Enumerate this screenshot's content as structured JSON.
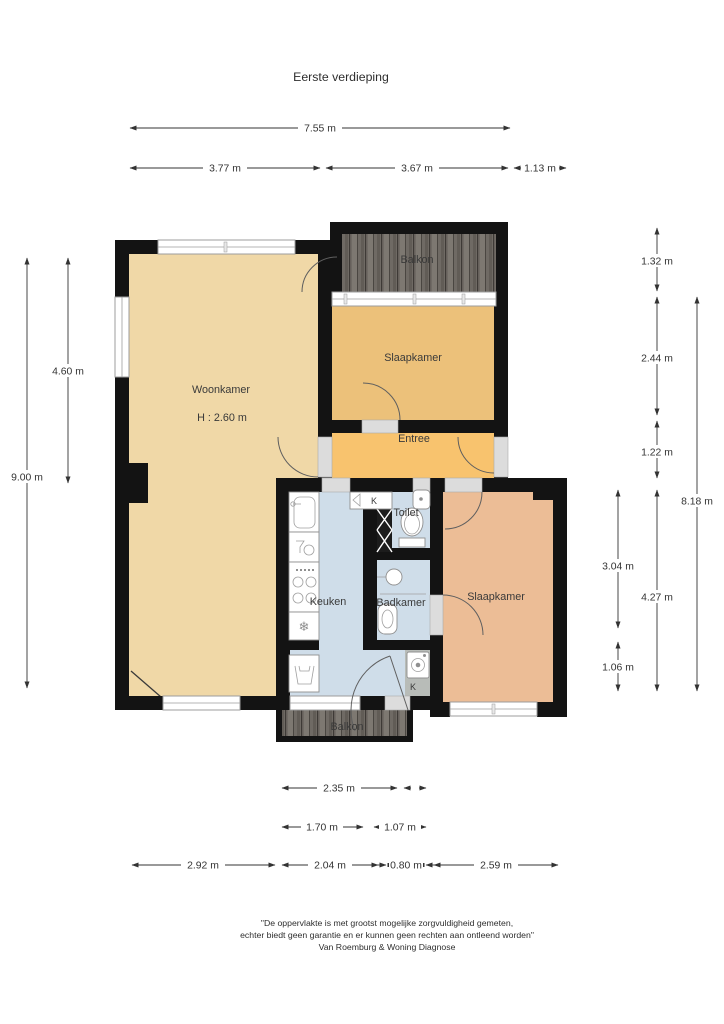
{
  "title": "Eerste verdieping",
  "rooms": {
    "woonkamer": "Woonkamer",
    "woonkamer_height": "H : 2.60 m",
    "slaapkamer_top": "Slaapkamer",
    "slaapkamer_bottom": "Slaapkamer",
    "entree": "Entree",
    "keuken": "Keuken",
    "badkamer": "Badkamer",
    "toilet": "Toilet",
    "balkon_top": "Balkon",
    "balkon_bottom": "Balkon",
    "closet_top": "K",
    "closet_bottom": "K"
  },
  "colors": {
    "woonkamer": "#f0d8a7",
    "slaapkamer_top": "#ecc17a",
    "entree": "#f8c36e",
    "wet_rooms": "#cfdde9",
    "slaapkamer_bottom": "#ecbd96",
    "closet_cell": "#b8bcb8",
    "wall": "#131313"
  },
  "dimensions": {
    "top_total": "7.55 m",
    "top_left": "3.77 m",
    "top_mid": "3.67 m",
    "top_right": "1.13 m",
    "left_outer": "9.00 m",
    "left_inner": "4.60 m",
    "right_seg1": "1.32 m",
    "right_seg2": "2.44 m",
    "right_seg3": "1.22 m",
    "right_seg4": "4.27 m",
    "right_total": "8.18 m",
    "right_inner1": "3.04 m",
    "right_inner2": "1.06 m",
    "bottom_r1": "2.35 m",
    "bottom_r2a": "1.70 m",
    "bottom_r2b": "1.07 m",
    "bottom_r3a": "2.92 m",
    "bottom_r3b": "2.04 m",
    "bottom_r3c": "0.80 m",
    "bottom_r3d": "2.59 m"
  },
  "footer": {
    "line1": "\"De oppervlakte is met grootst mogelijke zorgvuldigheid gemeten,",
    "line2": "echter biedt geen garantie en er kunnen geen rechten aan ontleend worden\"",
    "line3": "Van Roemburg & Woning Diagnose"
  }
}
